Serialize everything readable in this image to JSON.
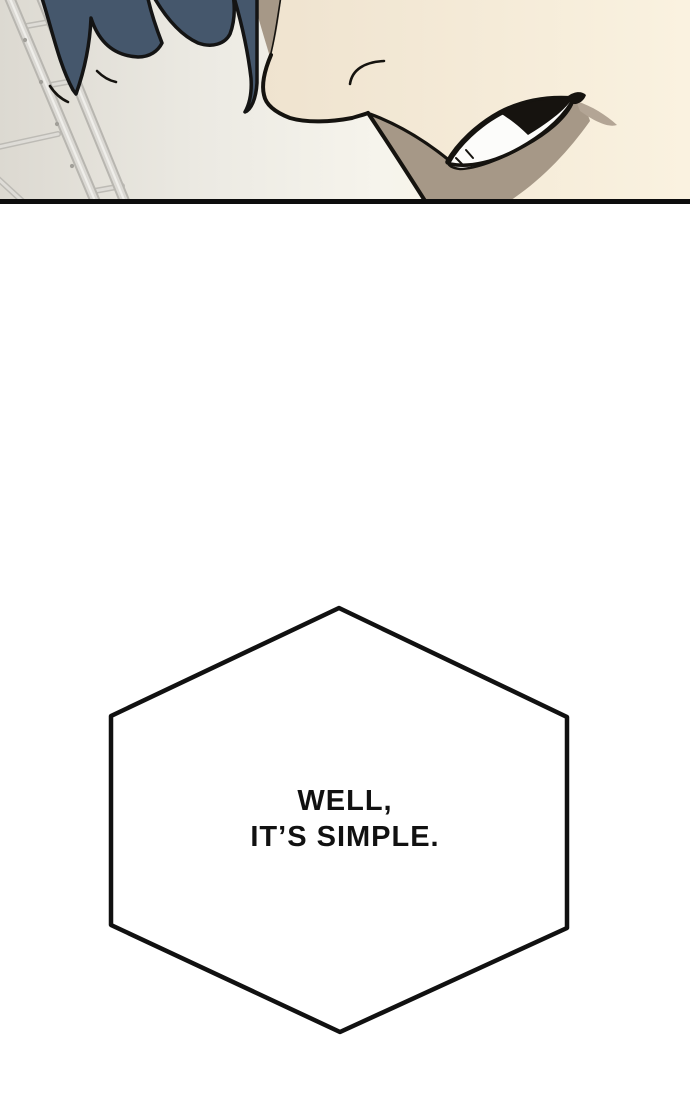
{
  "page": {
    "width": 690,
    "height": 1104,
    "background": "#ffffff"
  },
  "comic_panel": {
    "description": "Close-up from below of a character's jaw and mouth with gritted teeth; dark blue spiky hair above, a metal ladder in the left background.",
    "colors": {
      "background_left": "#dcd9d1",
      "background_right": "#fcf5e3",
      "hair": "#45576c",
      "skin_left": "#efe3cf",
      "skin_right": "#faf2e0",
      "shadow": "#a69887",
      "shadow_light": "#b3a595",
      "teeth": "#fcfcfa",
      "outline": "#15130f",
      "ladder_light": "#dbd9d4",
      "ladder_dark": "#b8b6b0",
      "panel_border": "#0d0d0d"
    }
  },
  "speech_bubble": {
    "shape": "hexagon",
    "fill": "#ffffff",
    "border": "#111111",
    "lines": [
      "WELL,",
      "IT’S SIMPLE."
    ]
  }
}
